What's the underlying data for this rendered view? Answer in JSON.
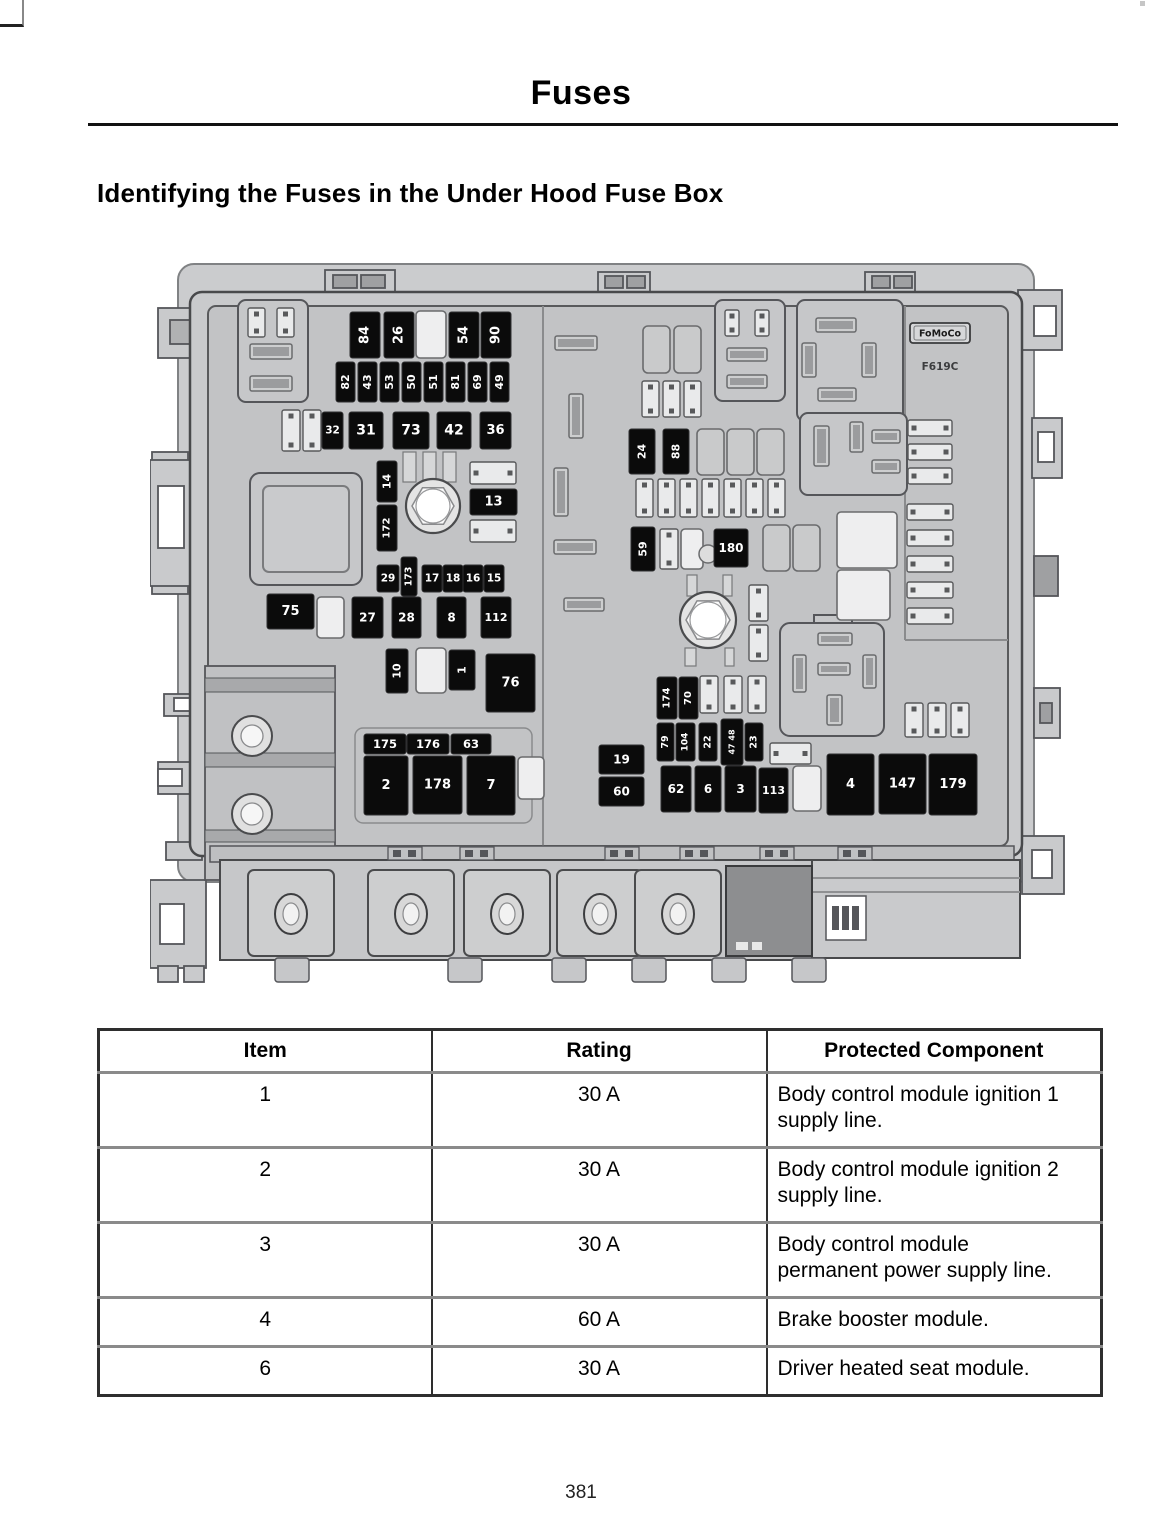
{
  "page": {
    "title": "Fuses",
    "heading": "Identifying the Fuses in the Under Hood Fuse Box",
    "page_number": "381"
  },
  "diagram": {
    "brand_label": "FoMoCo",
    "part_code": "F619C",
    "fuses": [
      {
        "label": "84",
        "x": 200,
        "y": 64,
        "w": 30,
        "h": 46,
        "o": "v",
        "fs": 13
      },
      {
        "label": "26",
        "x": 234,
        "y": 64,
        "w": 30,
        "h": 46,
        "o": "v",
        "fs": 13
      },
      {
        "label": "54",
        "x": 299,
        "y": 64,
        "w": 30,
        "h": 46,
        "o": "v",
        "fs": 13
      },
      {
        "label": "90",
        "x": 331,
        "y": 64,
        "w": 30,
        "h": 46,
        "o": "v",
        "fs": 13
      },
      {
        "label": "82",
        "x": 186,
        "y": 114,
        "w": 19,
        "h": 40,
        "o": "v",
        "fs": 11
      },
      {
        "label": "43",
        "x": 208,
        "y": 114,
        "w": 19,
        "h": 40,
        "o": "v",
        "fs": 11
      },
      {
        "label": "53",
        "x": 230,
        "y": 114,
        "w": 19,
        "h": 40,
        "o": "v",
        "fs": 11
      },
      {
        "label": "50",
        "x": 252,
        "y": 114,
        "w": 19,
        "h": 40,
        "o": "v",
        "fs": 11
      },
      {
        "label": "51",
        "x": 274,
        "y": 114,
        "w": 19,
        "h": 40,
        "o": "v",
        "fs": 11
      },
      {
        "label": "81",
        "x": 296,
        "y": 114,
        "w": 19,
        "h": 40,
        "o": "v",
        "fs": 11
      },
      {
        "label": "69",
        "x": 318,
        "y": 114,
        "w": 19,
        "h": 40,
        "o": "v",
        "fs": 11
      },
      {
        "label": "49",
        "x": 340,
        "y": 114,
        "w": 19,
        "h": 40,
        "o": "v",
        "fs": 11
      },
      {
        "label": "32",
        "x": 172,
        "y": 164,
        "w": 21,
        "h": 37,
        "o": "h",
        "fs": 10.5
      },
      {
        "label": "31",
        "x": 199,
        "y": 164,
        "w": 34,
        "h": 37,
        "o": "h",
        "fs": 14
      },
      {
        "label": "73",
        "x": 243,
        "y": 164,
        "w": 36,
        "h": 37,
        "o": "h",
        "fs": 14
      },
      {
        "label": "42",
        "x": 287,
        "y": 164,
        "w": 34,
        "h": 37,
        "o": "h",
        "fs": 14
      },
      {
        "label": "36",
        "x": 330,
        "y": 164,
        "w": 31,
        "h": 37,
        "o": "h",
        "fs": 13
      },
      {
        "label": "14",
        "x": 227,
        "y": 213,
        "w": 20,
        "h": 41,
        "o": "v",
        "fs": 11
      },
      {
        "label": "172",
        "x": 227,
        "y": 257,
        "w": 20,
        "h": 46,
        "o": "v",
        "fs": 10
      },
      {
        "label": "13",
        "x": 320,
        "y": 241,
        "w": 47,
        "h": 26,
        "o": "h",
        "fs": 13
      },
      {
        "label": "29",
        "x": 227,
        "y": 317,
        "w": 22,
        "h": 27,
        "o": "h",
        "fs": 10.5
      },
      {
        "label": "173",
        "x": 251,
        "y": 309,
        "w": 16,
        "h": 39,
        "o": "v",
        "fs": 9.5
      },
      {
        "label": "17",
        "x": 272,
        "y": 317,
        "w": 20,
        "h": 27,
        "o": "h",
        "fs": 10.5
      },
      {
        "label": "18",
        "x": 293,
        "y": 317,
        "w": 20,
        "h": 27,
        "o": "h",
        "fs": 10.5
      },
      {
        "label": "16",
        "x": 313,
        "y": 317,
        "w": 20,
        "h": 27,
        "o": "h",
        "fs": 10.5
      },
      {
        "label": "15",
        "x": 334,
        "y": 317,
        "w": 20,
        "h": 27,
        "o": "h",
        "fs": 10.5
      },
      {
        "label": "75",
        "x": 117,
        "y": 346,
        "w": 47,
        "h": 35,
        "o": "h",
        "fs": 13
      },
      {
        "label": "27",
        "x": 202,
        "y": 349,
        "w": 31,
        "h": 41,
        "o": "h",
        "fs": 12
      },
      {
        "label": "28",
        "x": 242,
        "y": 349,
        "w": 29,
        "h": 41,
        "o": "h",
        "fs": 12
      },
      {
        "label": "8",
        "x": 287,
        "y": 349,
        "w": 29,
        "h": 41,
        "o": "h",
        "fs": 12
      },
      {
        "label": "112",
        "x": 331,
        "y": 349,
        "w": 30,
        "h": 41,
        "o": "h",
        "fs": 11
      },
      {
        "label": "10",
        "x": 236,
        "y": 401,
        "w": 22,
        "h": 44,
        "o": "v",
        "fs": 11
      },
      {
        "label": "1",
        "x": 299,
        "y": 402,
        "w": 26,
        "h": 40,
        "o": "v",
        "fs": 11
      },
      {
        "label": "76",
        "x": 336,
        "y": 406,
        "w": 49,
        "h": 58,
        "o": "h",
        "fs": 13
      },
      {
        "label": "175",
        "x": 214,
        "y": 486,
        "w": 42,
        "h": 20,
        "o": "h",
        "fs": 11.5
      },
      {
        "label": "176",
        "x": 257,
        "y": 486,
        "w": 42,
        "h": 20,
        "o": "h",
        "fs": 11.5
      },
      {
        "label": "63",
        "x": 301,
        "y": 486,
        "w": 40,
        "h": 20,
        "o": "h",
        "fs": 11.5
      },
      {
        "label": "2",
        "x": 214,
        "y": 508,
        "w": 44,
        "h": 59,
        "o": "h",
        "fs": 13
      },
      {
        "label": "178",
        "x": 263,
        "y": 508,
        "w": 49,
        "h": 58,
        "o": "h",
        "fs": 13
      },
      {
        "label": "7",
        "x": 317,
        "y": 508,
        "w": 48,
        "h": 59,
        "o": "h",
        "fs": 13
      },
      {
        "label": "24",
        "x": 479,
        "y": 181,
        "w": 26,
        "h": 45,
        "o": "v",
        "fs": 11
      },
      {
        "label": "88",
        "x": 513,
        "y": 181,
        "w": 26,
        "h": 45,
        "o": "v",
        "fs": 11
      },
      {
        "label": "59",
        "x": 481,
        "y": 279,
        "w": 24,
        "h": 44,
        "o": "v",
        "fs": 11
      },
      {
        "label": "180",
        "x": 564,
        "y": 281,
        "w": 34,
        "h": 38,
        "o": "h",
        "fs": 12
      },
      {
        "label": "174",
        "x": 507,
        "y": 429,
        "w": 20,
        "h": 42,
        "o": "v",
        "fs": 10
      },
      {
        "label": "70",
        "x": 529,
        "y": 429,
        "w": 19,
        "h": 42,
        "o": "v",
        "fs": 10
      },
      {
        "label": "79",
        "x": 507,
        "y": 475,
        "w": 17,
        "h": 38,
        "o": "v",
        "fs": 9.5
      },
      {
        "label": "104",
        "x": 526,
        "y": 475,
        "w": 19,
        "h": 38,
        "o": "v",
        "fs": 9
      },
      {
        "label": "22",
        "x": 549,
        "y": 475,
        "w": 18,
        "h": 38,
        "o": "v",
        "fs": 9.5
      },
      {
        "label": "47 48",
        "x": 571,
        "y": 471,
        "w": 22,
        "h": 46,
        "o": "v",
        "fs": 8
      },
      {
        "label": "23",
        "x": 595,
        "y": 475,
        "w": 18,
        "h": 38,
        "o": "v",
        "fs": 9.5
      },
      {
        "label": "19",
        "x": 449,
        "y": 497,
        "w": 45,
        "h": 29,
        "o": "h",
        "fs": 12
      },
      {
        "label": "60",
        "x": 449,
        "y": 529,
        "w": 45,
        "h": 29,
        "o": "h",
        "fs": 12
      },
      {
        "label": "62",
        "x": 511,
        "y": 518,
        "w": 30,
        "h": 46,
        "o": "h",
        "fs": 12
      },
      {
        "label": "6",
        "x": 545,
        "y": 518,
        "w": 26,
        "h": 46,
        "o": "h",
        "fs": 12
      },
      {
        "label": "3",
        "x": 575,
        "y": 518,
        "w": 31,
        "h": 46,
        "o": "h",
        "fs": 12
      },
      {
        "label": "113",
        "x": 609,
        "y": 520,
        "w": 29,
        "h": 45,
        "o": "h",
        "fs": 11
      },
      {
        "label": "4",
        "x": 677,
        "y": 506,
        "w": 47,
        "h": 61,
        "o": "h",
        "fs": 13
      },
      {
        "label": "147",
        "x": 729,
        "y": 506,
        "w": 47,
        "h": 60,
        "o": "h",
        "fs": 13
      },
      {
        "label": "179",
        "x": 779,
        "y": 506,
        "w": 48,
        "h": 61,
        "o": "h",
        "fs": 13
      }
    ]
  },
  "table": {
    "headers": [
      "Item",
      "Rating",
      "Protected Component"
    ],
    "rows": [
      {
        "item": "1",
        "rating": "30 A",
        "component": "Body control module ignition 1 supply line."
      },
      {
        "item": "2",
        "rating": "30 A",
        "component": "Body control module ignition 2 supply line."
      },
      {
        "item": "3",
        "rating": "30 A",
        "component": "Body control module permanent power supply line."
      },
      {
        "item": "4",
        "rating": "60 A",
        "component": "Brake booster module."
      },
      {
        "item": "6",
        "rating": "30 A",
        "component": "Driver heated seat module."
      }
    ]
  }
}
